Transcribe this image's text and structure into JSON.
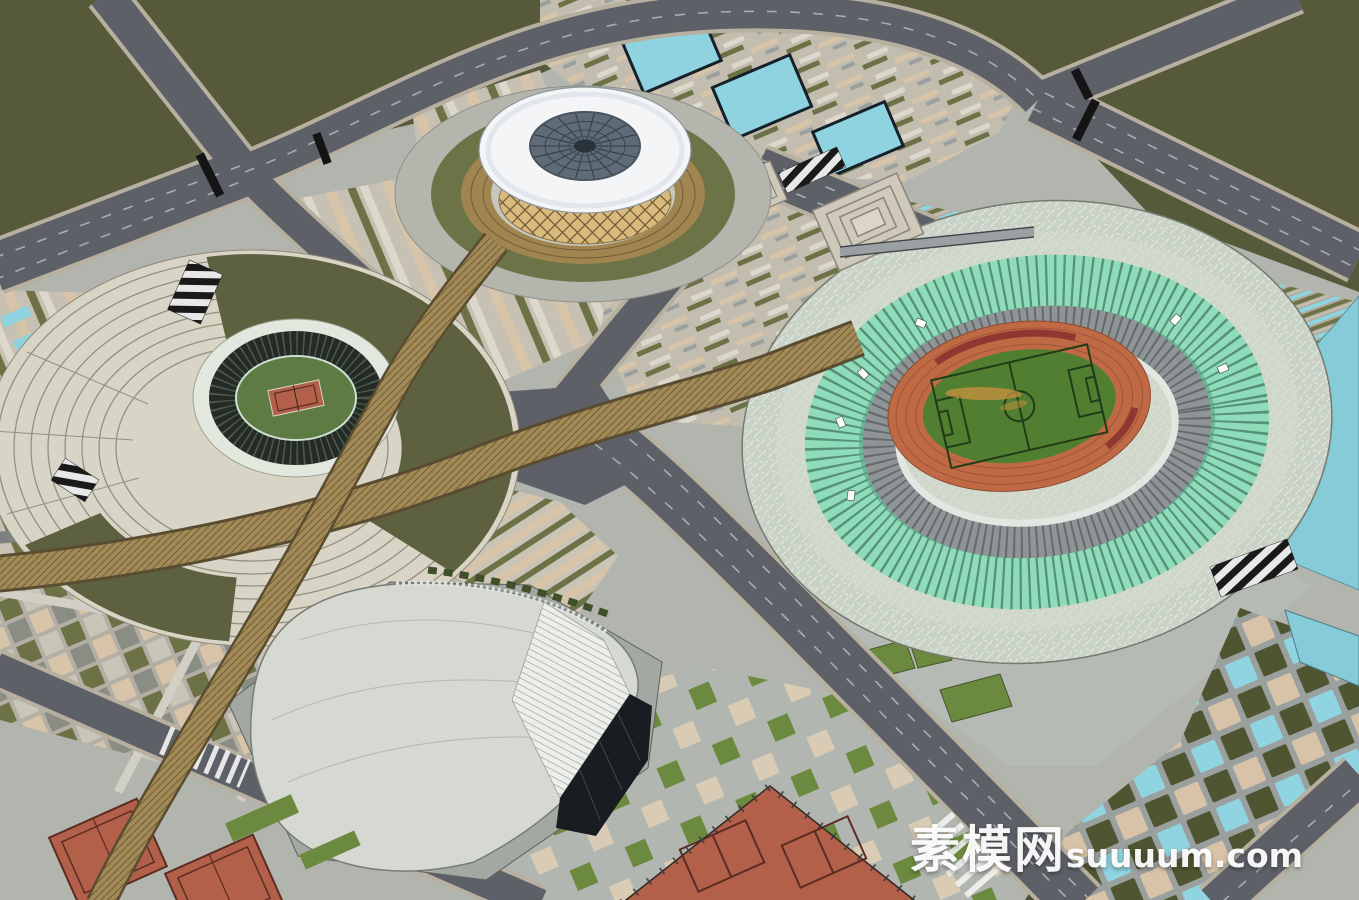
{
  "watermark": {
    "cn": "素模网",
    "latin": "suuuum.com"
  },
  "scene": {
    "description": "Aerial SketchUp-style architectural rendering of a sports-center masterplan",
    "elements": [
      "main-oval-stadium-with-track-and-soccer-pitch",
      "sunken-spiral-tennis-arena",
      "round-gymnasium-with-lattice-drum-and-skylight-roof",
      "curved-roof-natatorium",
      "outdoor-tennis-courts",
      "reflecting-pools",
      "timber-boardwalks",
      "plaza-paving-patterns",
      "perimeter-roads",
      "green-fields"
    ]
  },
  "palette": {
    "field_olive": "#565a3b",
    "asphalt": "#5d6167",
    "curb": "#b7b0a0",
    "dash": "#a7adb3",
    "plaza": "#b2b4ae",
    "stripe_beige": "#d8c4a8",
    "stripe_olive": "#6c7245",
    "stripe_light": "#dcd8cb",
    "pool_cyan": "#8ed3df",
    "water": "#85ccd8",
    "mosaic": "#c9d2c6",
    "seat_mint": "#8fdcba",
    "seat_gray": "#8f9496",
    "track_orange": "#bf6a44",
    "hoarding": "#8e3831",
    "grass": "#507f31",
    "worn": "#c9913f",
    "field_line": "#233c18",
    "arena_plaza": "#d9d5c6",
    "arena_ring": "#94907f",
    "arena_olive": "#5d6140",
    "bowl_white": "#e3e8df",
    "bowl_seat": "#232b24",
    "bowl_green": "#5e7b43",
    "court": "#b2604a",
    "court_line": "#5c2c22",
    "dome_white": "#f3f5f7",
    "dome_glass": "#5f6c77",
    "dome_spoke": "#2f3b45",
    "lattice_tan": "#d9b97c",
    "lattice_line": "#6b5a33",
    "ring_brown": "#a08550",
    "ring_green": "#6b7347",
    "bw_tan": "#a28a56",
    "bw_line": "#6f5c38",
    "bldg_roof": "#d6d8d2",
    "glass": "#191c20",
    "louver": "#eceeea",
    "lawn": "#6b8a3f",
    "tile_olive": "#4f5531",
    "tile_cyan": "#8fd4e0",
    "tile_beige": "#d9c3a8",
    "stair_black": "#1a1a1a",
    "stair_white": "#e8e8e8"
  }
}
